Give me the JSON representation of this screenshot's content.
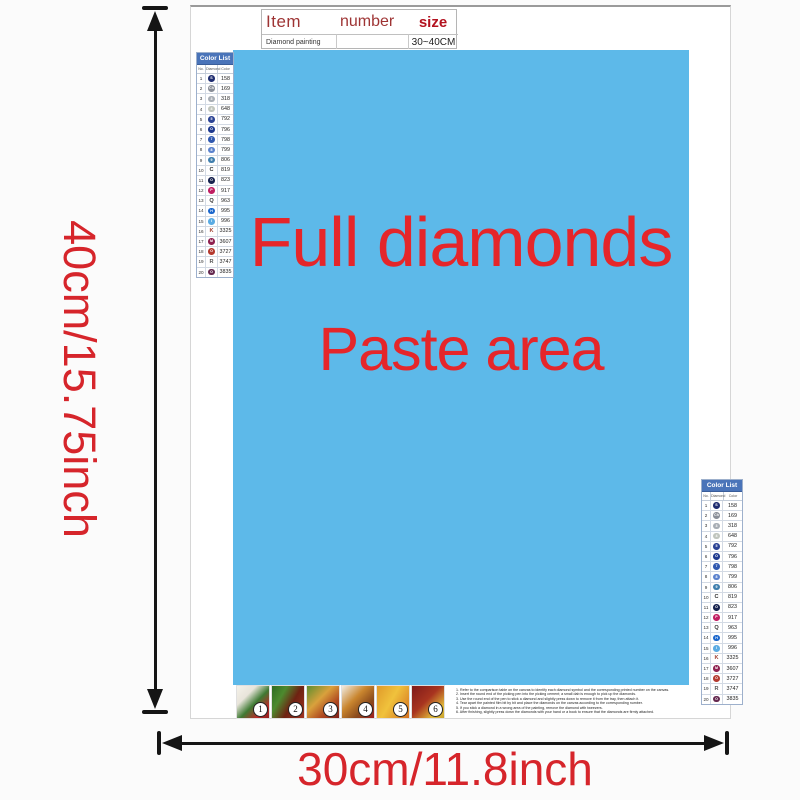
{
  "item_table": {
    "headers": [
      "Item",
      "number",
      "size"
    ],
    "row": {
      "item": "Diamond painting",
      "number": "",
      "size": "30~40CM"
    }
  },
  "canvas": {
    "line1": "Full diamonds",
    "line2": "Paste area",
    "bg_color": "#5db9e9",
    "text_color": "#e5262a"
  },
  "dimensions": {
    "height_label": "40cm/15.75inch",
    "width_label": "30cm/11.8inch",
    "text_color": "#d6252b",
    "arrow_color": "#151515"
  },
  "color_list": {
    "title": "Color List",
    "columns": [
      "No.",
      "Diamond",
      "Color"
    ],
    "header_bg": "#4a74b9",
    "rows": [
      {
        "no": "1",
        "sym": "S",
        "code": "158",
        "type": "circle",
        "bg": "#1f2d71"
      },
      {
        "no": "2",
        "sym": "Ch",
        "code": "169",
        "type": "circle",
        "bg": "#8a8f98"
      },
      {
        "no": "3",
        "sym": "3",
        "code": "318",
        "type": "circle",
        "bg": "#a7adb4"
      },
      {
        "no": "4",
        "sym": "4",
        "code": "648",
        "type": "circle",
        "bg": "#c0c5bd"
      },
      {
        "no": "5",
        "sym": "5",
        "code": "792",
        "type": "circle",
        "bg": "#2c4495"
      },
      {
        "no": "6",
        "sym": "O",
        "code": "796",
        "type": "circle",
        "bg": "#1e3a8f"
      },
      {
        "no": "7",
        "sym": "7",
        "code": "798",
        "type": "circle",
        "bg": "#3059b0"
      },
      {
        "no": "8",
        "sym": "8",
        "code": "799",
        "type": "circle",
        "bg": "#5b82cd"
      },
      {
        "no": "9",
        "sym": "9",
        "code": "806",
        "type": "circle",
        "bg": "#3f7fae"
      },
      {
        "no": "10",
        "sym": "C",
        "code": "819",
        "type": "letter",
        "fg": "#333333"
      },
      {
        "no": "11",
        "sym": "O",
        "code": "823",
        "type": "circle",
        "bg": "#16224e"
      },
      {
        "no": "12",
        "sym": "P",
        "code": "917",
        "type": "circle",
        "bg": "#c01e62"
      },
      {
        "no": "13",
        "sym": "Q",
        "code": "963",
        "type": "letter",
        "fg": "#333333"
      },
      {
        "no": "14",
        "sym": "H",
        "code": "995",
        "type": "circle",
        "bg": "#1a66cc"
      },
      {
        "no": "15",
        "sym": "I",
        "code": "996",
        "type": "circle",
        "bg": "#5aabe3"
      },
      {
        "no": "16",
        "sym": "K",
        "code": "3325",
        "type": "letter",
        "fg": "#a04030"
      },
      {
        "no": "17",
        "sym": "M",
        "code": "3607",
        "type": "circle",
        "bg": "#8f2150"
      },
      {
        "no": "18",
        "sym": "O",
        "code": "3727",
        "type": "circle",
        "bg": "#b43a30"
      },
      {
        "no": "19",
        "sym": "R",
        "code": "3747",
        "type": "letter",
        "fg": "#555555"
      },
      {
        "no": "20",
        "sym": "O",
        "code": "3835",
        "type": "circle",
        "bg": "#64284f"
      }
    ]
  },
  "thumbnails": [
    {
      "label": "1",
      "gradient": "linear-gradient(135deg,#f5f2ea 0%,#e8e4da 30%,#3f7a33 55%,#b92a28 80%,#8f1f1e 100%)"
    },
    {
      "label": "2",
      "gradient": "linear-gradient(120deg,#2e6b22 0%,#4d8a2e 30%,#6e2212 60%,#a03322 100%)"
    },
    {
      "label": "3",
      "gradient": "linear-gradient(135deg,#5d8d2f 0%,#d9a13c 40%,#b04a20 70%,#7e1f18 100%)"
    },
    {
      "label": "4",
      "gradient": "linear-gradient(135deg,#f0ece2 0%,#c9852e 40%,#8a4a1c 70%,#a02020 100%)"
    },
    {
      "label": "5",
      "gradient": "linear-gradient(120deg,#e09a2a 0%,#f0c23c 45%,#d4701f 100%)"
    },
    {
      "label": "6",
      "gradient": "linear-gradient(135deg,#7e1a1a 0%,#a8341f 45%,#e0b93a 80%,#caa52f 100%)"
    }
  ],
  "instructions": {
    "lines": [
      "1. Refer to the comparison table on the canvas to identify each diamond symbol and the corresponding printed number on the canvas.",
      "2. Insert the round end of the picking pen into the picking cement; a small dab is enough to pick up the diamonds.",
      "3. Use the round end of the pen to stick a diamond and slightly press down to remove it from the tray, then attach it.",
      "4. Tear apart the painted film bit by bit and place the diamonds on the canvas according to the corresponding number.",
      "5. If you stick a diamond in a wrong area of the painting, remove the diamond with tweezers.",
      "6. After finishing, slightly press down the diamonds with your hand or a book to ensure that the diamonds are firmly attached."
    ]
  }
}
